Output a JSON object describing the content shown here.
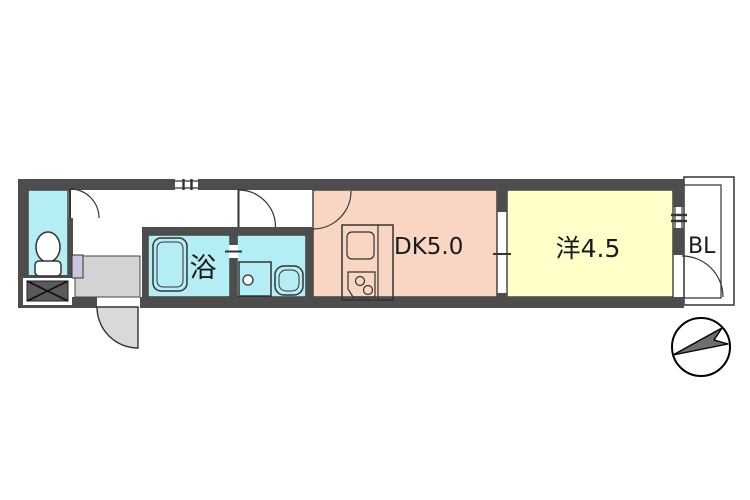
{
  "floorplan": {
    "rooms": {
      "bath": {
        "label": "浴"
      },
      "dining_kitchen": {
        "label": "DK5.0"
      },
      "western_room": {
        "label": "洋4.5"
      },
      "balcony": {
        "label": "BL"
      }
    },
    "colors": {
      "wall": "#4d4d4d",
      "water_room": "#b5edf5",
      "dining_kitchen": "#f9d6c3",
      "western_room": "#ffffc9",
      "entrance_floor": "#d3d3d3",
      "door_swing": "#d9d9d9",
      "shelf": "#c9c5e3",
      "shoe_box": "#5a5a5a",
      "compass_needle": "#6e6e6e"
    },
    "fixtures": [
      "toilet",
      "bathtub",
      "washing-machine-pan",
      "wash-basin",
      "kitchen-sink",
      "gas-stove",
      "shoe-box",
      "compass"
    ]
  }
}
